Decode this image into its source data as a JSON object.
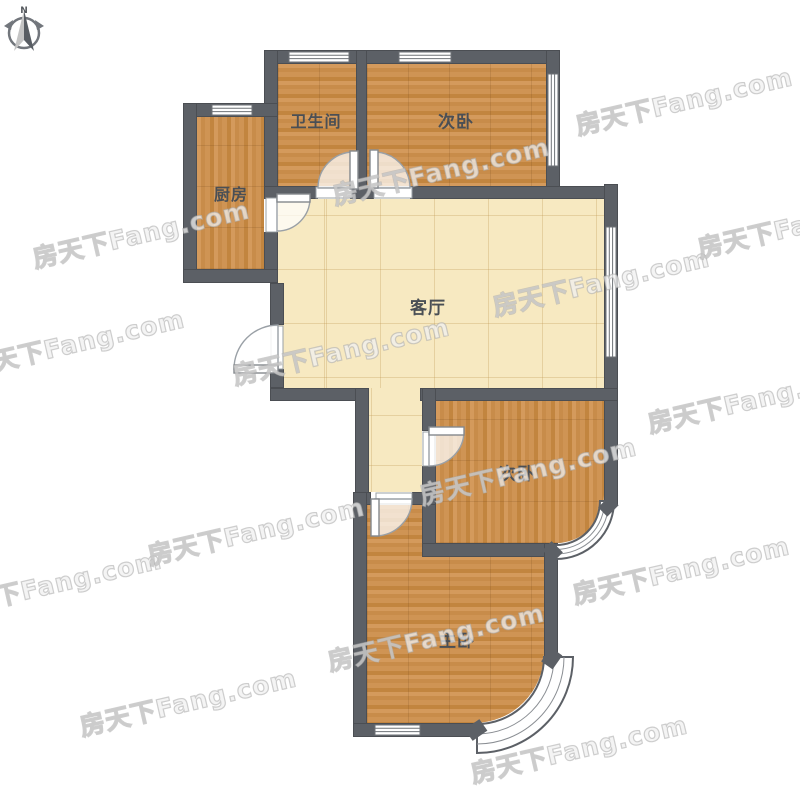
{
  "compass": {
    "north_label": "N"
  },
  "watermark": {
    "text": "房天下Fang.com"
  },
  "rooms": {
    "bathroom": {
      "label": "卫生间"
    },
    "bedroom_top": {
      "label": "次卧"
    },
    "kitchen": {
      "label": "厨房"
    },
    "living_room": {
      "label": "客厅"
    },
    "bedroom_mid": {
      "label": "次卧"
    },
    "master_bedroom": {
      "label": "主卧"
    }
  },
  "colors": {
    "wall": "#5c6066",
    "wood_floor": "#cd9150",
    "tile_floor": "#f7e9c1",
    "room_label": "#4a4f55",
    "watermark": "#c8c8c8",
    "window_fill": "#ffffff"
  }
}
